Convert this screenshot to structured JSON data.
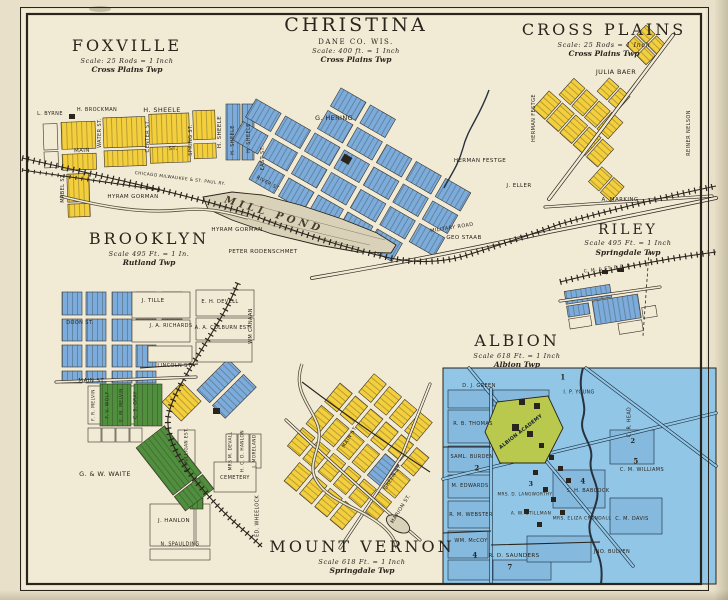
{
  "palette": {
    "paper": "#e8e0c8",
    "panel": "#f1ead5",
    "ink": "#2a241c",
    "yellow": "#f3cf3d",
    "blue": "#7cacdb",
    "green": "#4f8f3e",
    "albion_blue": "#92c6e6",
    "albion_block": "#85b9dd",
    "academy_green": "#b9c94e",
    "pond": "#d9d2b8",
    "water": "#27323e"
  },
  "towns": {
    "foxville": {
      "title": "FOXVILLE",
      "scale": "Scale: 25 Rods = 1 Inch",
      "township": "Cross Plains Twp",
      "labels": [
        {
          "text": "L. BYRNE",
          "x": 50,
          "y": 114,
          "size": 5
        },
        {
          "text": "H. BROCKMAN",
          "x": 97,
          "y": 110,
          "size": 5
        },
        {
          "text": "H. SHEELE",
          "x": 162,
          "y": 110,
          "size": 6.5
        },
        {
          "text": "H. SHEELE",
          "x": 220,
          "y": 132,
          "size": 5.5,
          "rot": -90
        },
        {
          "text": "MAIN",
          "x": 82,
          "y": 151,
          "size": 5.5,
          "rot": -2
        },
        {
          "text": "ST.",
          "x": 173,
          "y": 149,
          "size": 5.5,
          "rot": -2
        },
        {
          "text": "WATER ST.",
          "x": 100,
          "y": 133,
          "size": 5,
          "rot": -90
        },
        {
          "text": "CENTER ST.",
          "x": 148,
          "y": 136,
          "size": 5,
          "rot": -90
        },
        {
          "text": "SPRING ST.",
          "x": 191,
          "y": 140,
          "size": 5,
          "rot": -90
        },
        {
          "text": "MABEL ST.",
          "x": 63,
          "y": 188,
          "size": 5,
          "rot": -90
        },
        {
          "text": "HYRAM GORMAN",
          "x": 133,
          "y": 197,
          "size": 5.5
        },
        {
          "text": "CHICAGO MILWAUKEE & ST. PAUL RY.",
          "x": 180,
          "y": 179,
          "size": 4.3,
          "rot": 7
        }
      ]
    },
    "christina": {
      "title": "CHRISTINA",
      "subtitle": "DANE CO.  WIS.",
      "scale": "Scale: 400 ft. = 1 Inch",
      "township": "Cross Plains Twp",
      "labels": [
        {
          "text": "G. HERING",
          "x": 334,
          "y": 118,
          "size": 6.5
        },
        {
          "text": "H. SHEELE",
          "x": 233,
          "y": 140,
          "size": 5,
          "rot": -90
        },
        {
          "text": "H. SHEELE",
          "x": 249,
          "y": 138,
          "size": 5,
          "rot": -90
        },
        {
          "text": "EAST ST.",
          "x": 263,
          "y": 158,
          "size": 5,
          "rot": -90
        },
        {
          "text": "RIVER ST.",
          "x": 268,
          "y": 184,
          "size": 4.8,
          "rot": 28
        },
        {
          "text": "MILL POND",
          "x": 274,
          "y": 215,
          "size": 10,
          "rot": 17,
          "cls": "pond-label"
        },
        {
          "text": "HERMAN FESTGE",
          "x": 480,
          "y": 161,
          "size": 5.5
        },
        {
          "text": "HYRAM GORMAN",
          "x": 237,
          "y": 230,
          "size": 5.5
        },
        {
          "text": "PETER RODENSCHMET",
          "x": 263,
          "y": 252,
          "size": 5.5
        },
        {
          "text": "MILITARY ROAD",
          "x": 452,
          "y": 228,
          "size": 5,
          "rot": -9
        },
        {
          "text": "GEO STAAB",
          "x": 464,
          "y": 238,
          "size": 5.5
        }
      ]
    },
    "cross_plains": {
      "title": "CROSS PLAINS",
      "scale": "Scale: 25 Rods = 1 Inch",
      "township": "Cross Plains Twp",
      "labels": [
        {
          "text": "JULIA BAER",
          "x": 616,
          "y": 72,
          "size": 6.5
        },
        {
          "text": "HERMAN FESTGE",
          "x": 534,
          "y": 118,
          "size": 5,
          "rot": -90
        },
        {
          "text": "J. ELLER",
          "x": 519,
          "y": 186,
          "size": 5.5
        },
        {
          "text": "A. MARKING",
          "x": 620,
          "y": 200,
          "size": 5.5
        },
        {
          "text": "REINER NELSON",
          "x": 689,
          "y": 133,
          "size": 5,
          "rot": -90
        }
      ]
    },
    "riley": {
      "title": "RILEY",
      "scale": "Scale 495 Ft. = 1 Inch",
      "township": "Springdale Twp",
      "labels": [
        {
          "text": "C. M. & ST. P. R. R.",
          "x": 608,
          "y": 269,
          "size": 4.5,
          "rot": -7
        }
      ]
    },
    "brooklyn": {
      "title": "BROOKLYN",
      "scale": "Scale 495 Ft. = 1 In.",
      "township": "Rutland Twp",
      "labels": [
        {
          "text": "J. TILLE",
          "x": 153,
          "y": 301,
          "size": 5.5
        },
        {
          "text": "E. H. DEVELL",
          "x": 220,
          "y": 302,
          "size": 5
        },
        {
          "text": "J. A. RICHARDS",
          "x": 171,
          "y": 326,
          "size": 5
        },
        {
          "text": "A. A. COLBURN EST.",
          "x": 223,
          "y": 328,
          "size": 5
        },
        {
          "text": "DOON ST.",
          "x": 80,
          "y": 323,
          "size": 5
        },
        {
          "text": "LINCOLN ST.",
          "x": 175,
          "y": 366,
          "size": 5
        },
        {
          "text": "MAIN ST.",
          "x": 92,
          "y": 381,
          "size": 5.5
        },
        {
          "text": "WM CANAAN",
          "x": 251,
          "y": 326,
          "size": 5,
          "rot": -90
        },
        {
          "text": "F. R. MELVIN",
          "x": 94,
          "y": 405,
          "size": 4.5,
          "rot": -90
        },
        {
          "text": "F. V. WOLF",
          "x": 108,
          "y": 405,
          "size": 4.5,
          "rot": -90
        },
        {
          "text": "E. M. MELVIN",
          "x": 122,
          "y": 405,
          "size": 4.5,
          "rot": -90
        },
        {
          "text": "C. S. GRAY",
          "x": 136,
          "y": 405,
          "size": 4.5,
          "rot": -90
        },
        {
          "text": "R. MULLIGAN EST.",
          "x": 187,
          "y": 450,
          "size": 4.3,
          "rot": -90
        },
        {
          "text": "MRS M. DEVALL",
          "x": 231,
          "y": 451,
          "size": 4.3,
          "rot": -90
        },
        {
          "text": "H. C. D. HANLON",
          "x": 243,
          "y": 451,
          "size": 4.3,
          "rot": -90
        },
        {
          "text": "J. MORELAND",
          "x": 255,
          "y": 451,
          "size": 4.3,
          "rot": -90
        },
        {
          "text": "CEMETERY",
          "x": 235,
          "y": 478,
          "size": 5
        },
        {
          "text": "G. & W. WAITE",
          "x": 105,
          "y": 474,
          "size": 6.5
        },
        {
          "text": "J. HANLON",
          "x": 174,
          "y": 521,
          "size": 5.5
        },
        {
          "text": "N. SPAULDING",
          "x": 180,
          "y": 545,
          "size": 4.8
        },
        {
          "text": "ED. WHEELOCK",
          "x": 258,
          "y": 516,
          "size": 4.8,
          "rot": -90
        }
      ]
    },
    "albion": {
      "title": "ALBION",
      "scale": "Scale 618 Ft. = 1 Inch",
      "township": "Albion Twp",
      "labels": [
        {
          "text": "D. J. GREEN",
          "x": 479,
          "y": 386,
          "size": 5
        },
        {
          "text": "I. P. YOUNG",
          "x": 579,
          "y": 393,
          "size": 4.8
        },
        {
          "text": "R. B. THOMAS",
          "x": 473,
          "y": 424,
          "size": 5
        },
        {
          "text": "SAML. BURDEN",
          "x": 472,
          "y": 457,
          "size": 5
        },
        {
          "text": "2",
          "x": 477,
          "y": 468,
          "size": 7,
          "cls": "blocknum"
        },
        {
          "text": "M. EDWARDS",
          "x": 470,
          "y": 486,
          "size": 5
        },
        {
          "text": "R. M. WEBSTER",
          "x": 471,
          "y": 515,
          "size": 5
        },
        {
          "text": "WM. McCOY",
          "x": 471,
          "y": 541,
          "size": 5
        },
        {
          "text": "4",
          "x": 475,
          "y": 555,
          "size": 7,
          "cls": "blocknum"
        },
        {
          "text": "R. D. SAUNDERS",
          "x": 514,
          "y": 556,
          "size": 5.5
        },
        {
          "text": "7",
          "x": 510,
          "y": 567,
          "size": 7,
          "cls": "blocknum"
        },
        {
          "text": "MRS. D. LANGWORTHY",
          "x": 525,
          "y": 494,
          "size": 4.2
        },
        {
          "text": "3",
          "x": 531,
          "y": 484,
          "size": 6.5,
          "cls": "blocknum"
        },
        {
          "text": "A. W. STILLMAN",
          "x": 531,
          "y": 514,
          "size": 4.5
        },
        {
          "text": "S. H. BABCOCK",
          "x": 588,
          "y": 491,
          "size": 5
        },
        {
          "text": "4",
          "x": 583,
          "y": 481,
          "size": 7,
          "cls": "blocknum"
        },
        {
          "text": "MRS. ELIZA CRANDALL",
          "x": 582,
          "y": 519,
          "size": 4.5
        },
        {
          "text": "C. M. DAVIS",
          "x": 632,
          "y": 519,
          "size": 5
        },
        {
          "text": "JNO. BULVEN",
          "x": 612,
          "y": 552,
          "size": 5
        },
        {
          "text": "C. M. WILLIAMS",
          "x": 642,
          "y": 470,
          "size": 5
        },
        {
          "text": "5",
          "x": 636,
          "y": 461,
          "size": 7,
          "cls": "blocknum"
        },
        {
          "text": "C. R. HEAD",
          "x": 630,
          "y": 422,
          "size": 4.8,
          "rot": -90
        },
        {
          "text": "2",
          "x": 633,
          "y": 441,
          "size": 6.5,
          "cls": "blocknum"
        },
        {
          "text": "1",
          "x": 563,
          "y": 377,
          "size": 7,
          "cls": "blocknum"
        },
        {
          "text": "ALBION ACADEMY",
          "x": 521,
          "y": 432,
          "size": 5,
          "rot": -38,
          "cls": "academy-label"
        }
      ]
    },
    "mount_vernon": {
      "title": "MOUNT VERNON",
      "scale": "Scale 618 Ft. = 1 Inch",
      "township": "Springdale Twp",
      "labels": [
        {
          "text": "MAIN ST.",
          "x": 350,
          "y": 437,
          "size": 5,
          "rot": -58
        },
        {
          "text": "GREEN ST.",
          "x": 393,
          "y": 477,
          "size": 5,
          "rot": -58
        },
        {
          "text": "MARION ST.",
          "x": 401,
          "y": 509,
          "size": 5,
          "rot": -58
        }
      ]
    }
  }
}
